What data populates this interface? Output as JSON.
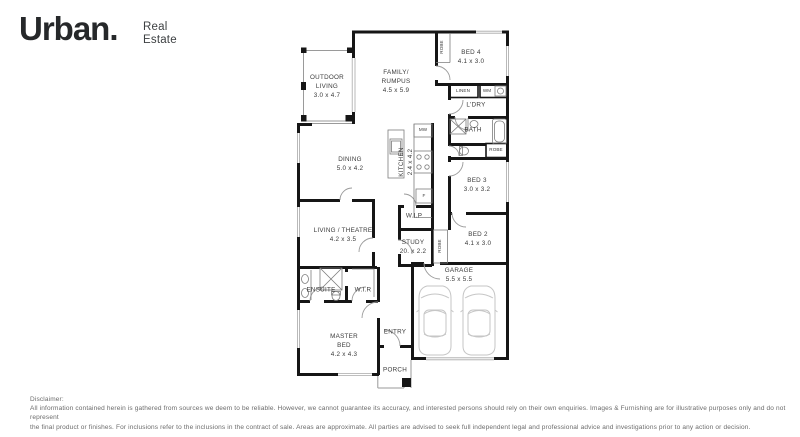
{
  "brand": {
    "wordmark": "Urban.",
    "sub_line1": "Real",
    "sub_line2": "Estate"
  },
  "plan": {
    "rooms": {
      "outdoor_living": {
        "line1": "OUTDOOR",
        "line2": "LIVING",
        "dims": "3.0 x 4.7"
      },
      "family_rumpus": {
        "line1": "FAMILY/",
        "line2": "RUMPUS",
        "dims": "4.5 x 5.9"
      },
      "bed4": {
        "name": "BED 4",
        "dims": "4.1 x 3.0"
      },
      "laundry": {
        "name": "L'DRY"
      },
      "bath": {
        "name": "BATH"
      },
      "bed3": {
        "name": "BED 3",
        "dims": "3.0 x 3.2"
      },
      "dining": {
        "name": "DINING",
        "dims": "5.0 x 4.2"
      },
      "kitchen": {
        "name": "KITCHEN",
        "dims": "2.4 x 4.2"
      },
      "wip": {
        "name": "W.I.P"
      },
      "living_theatre": {
        "name": "LIVING / THEATRE",
        "dims": "4.2 x 3.5"
      },
      "study": {
        "name": "STUDY",
        "dims": "20. x 2.2"
      },
      "bed2": {
        "name": "BED 2",
        "dims": "4.1 x 3.0"
      },
      "garage": {
        "name": "GARAGE",
        "dims": "5.5 x 5.5"
      },
      "ensuite": {
        "name": "ENSUITE"
      },
      "wir": {
        "name": "W.I.R"
      },
      "master_bed": {
        "line1": "MASTER",
        "line2": "BED",
        "dims": "4.2 x 4.3"
      },
      "entry": {
        "name": "ENTRY"
      },
      "porch": {
        "name": "PORCH"
      }
    },
    "fixtures": {
      "robe_bed4": "ROBE",
      "linen": "LINEN",
      "wm": "WM",
      "robe_bath": "ROBE",
      "mw": "MW",
      "fridge": "F",
      "robe_bed2": "ROBE"
    },
    "colors": {
      "wall": "#161616",
      "fixture": "#7d7d7d",
      "car": "#c6c6c6"
    }
  },
  "disclaimer": {
    "title": "Disclaimer:",
    "line1": "All information contained herein is gathered from sources we deem to be reliable. However, we cannot guarantee its accuracy, and interested persons should rely on their own enquiries. Images & Furnishing are for illustrative purposes only and do not represent",
    "line2": "the final product or finishes. For inclusions refer to the inclusions in the contract of sale. Areas are approximate. All parties are advised to seek full independent legal and professional advice and investigations prior to any action or decision."
  }
}
